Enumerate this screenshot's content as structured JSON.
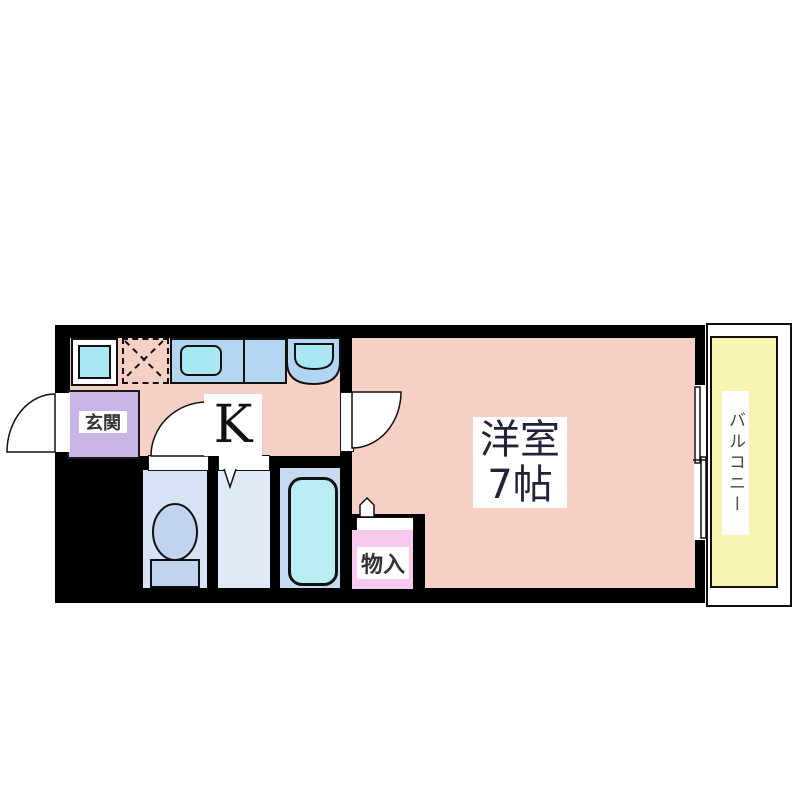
{
  "floorplan": {
    "type": "apartment-1K-floor-plan",
    "rooms": {
      "kitchen_label": "K",
      "entrance_label": "玄関",
      "western_room_label_line1": "洋室",
      "western_room_label_line2": "7帖",
      "storage_label": "物入",
      "balcony_label": "バルコニー"
    },
    "colors": {
      "wall": "#000000",
      "room_floor": "#f6d0c4",
      "entrance": "#c9b4e8",
      "storage": "#f7c9ee",
      "balcony": "#f9f4b1",
      "counter_blue": "#b3d5f1",
      "fixture_cyan": "#a9e7f3",
      "toilet_room": "#d5e3f5",
      "washroom": "#e0eaf7",
      "bathroom": "#c6dbf1",
      "bathtub": "#b9edf4",
      "page_background": "#ffffff"
    }
  }
}
